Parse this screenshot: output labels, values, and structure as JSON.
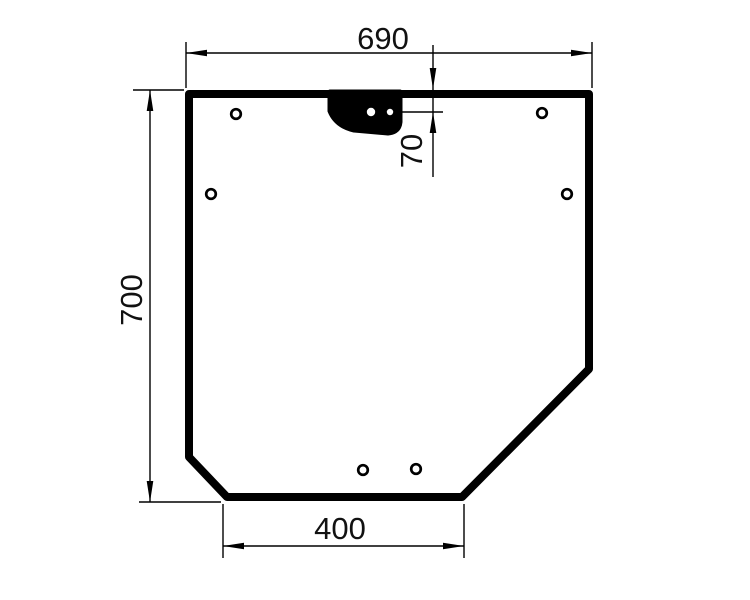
{
  "drawing": {
    "type": "technical-outline-drawing",
    "background_color": "#ffffff",
    "line_color": "#000000",
    "labels": {
      "top_width": "690",
      "left_height": "700",
      "hole_offset": "70",
      "bottom_width": "400"
    }
  }
}
